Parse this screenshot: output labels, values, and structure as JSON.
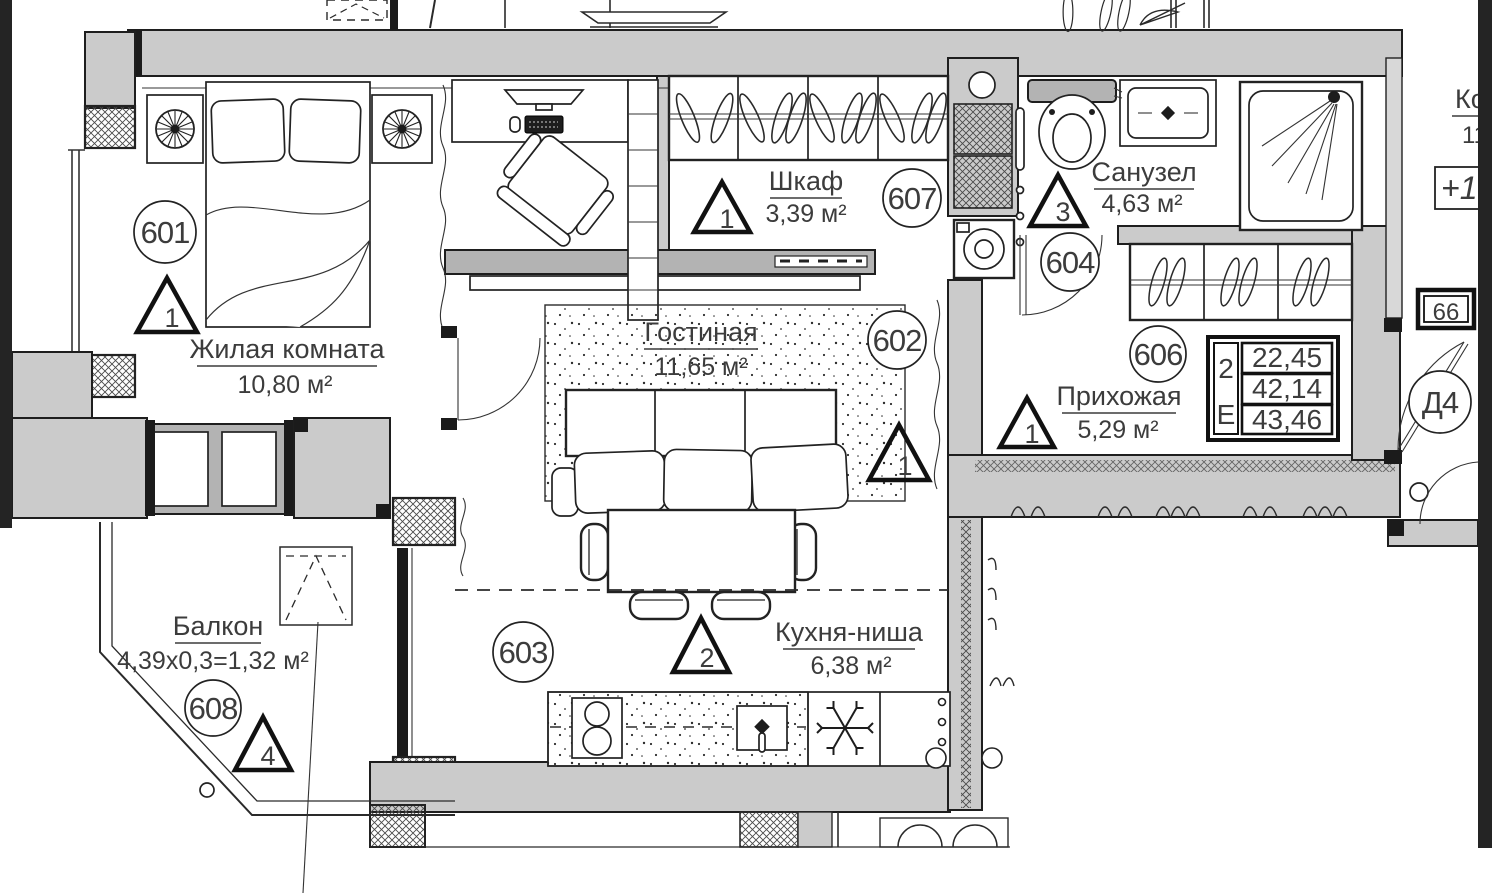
{
  "plan_title": "apartment-floor-plan-unit-66",
  "colors": {
    "wall_fill": "#cbcbcb",
    "line": "#1e1e1e",
    "edge_dark": "#262626",
    "text": "#3c3c3c"
  },
  "rooms": {
    "bedroom": {
      "number": "601",
      "name": "Жилая комната",
      "area": "10,80 м²",
      "vent": "1"
    },
    "closet": {
      "number": "607",
      "name": "Шкаф",
      "area": "3,39 м²",
      "vent": "1"
    },
    "living": {
      "number": "602",
      "name": "Гостиная",
      "area": "11,65 м²",
      "vent": "1"
    },
    "bathroom": {
      "number": "604",
      "name": "Санузел",
      "area": "4,63 м²",
      "vent": "3"
    },
    "hallway": {
      "number": "606",
      "name": "Прихожая",
      "area": "5,29 м²",
      "vent": "1"
    },
    "kitchen": {
      "number": "603",
      "name": "Кухня-ниша",
      "area": "6,38 м²",
      "vent": "2"
    },
    "balcony": {
      "number": "608",
      "name": "Балкон",
      "area": "4,39x0,3=1,32 м²",
      "vent": "4"
    }
  },
  "summary_table": {
    "rooms_count": "2",
    "type_letter": "Е",
    "rows": [
      "22,45",
      "42,14",
      "43,46"
    ]
  },
  "marks": {
    "door_label": "Д4",
    "unit_number": "66",
    "elevation": "+17",
    "neighbor_name": "Ко",
    "neighbor_area": "11"
  },
  "symbols": [
    "vent-triangle",
    "room-number-circle",
    "hanger",
    "fan-lamp",
    "snowflake-fridge",
    "shower-head",
    "window-crosshatch"
  ]
}
